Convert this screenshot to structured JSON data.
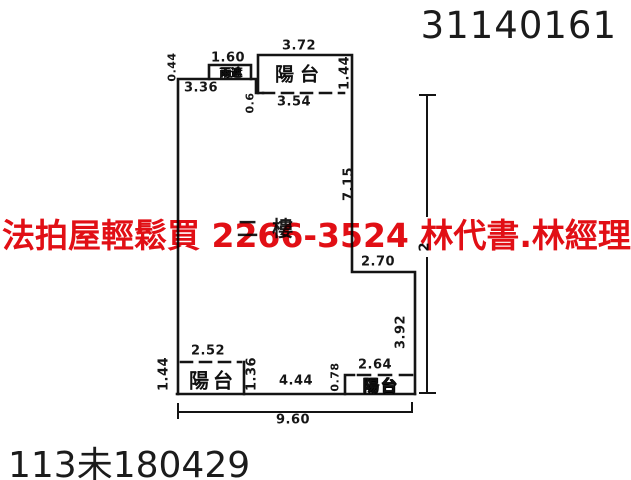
{
  "header": {
    "ref_number": "31140161"
  },
  "footer": {
    "case_number": "113未180429"
  },
  "watermark": {
    "text": "法拍屋輕鬆買  2266-3524  林代書.林經理",
    "color": "#e10f15"
  },
  "floorplan": {
    "floor_label": "二樓",
    "rooms": {
      "rain_cover_label": "雨遮",
      "balcony_top_label": "陽台",
      "balcony_bottom_left_label": "陽台",
      "balcony_bottom_right_label": "陽台"
    },
    "dimensions": {
      "rain_cover_height": "0.44",
      "rain_cover_width": "1.60",
      "top_wall": "3.36",
      "top_step": "0.6",
      "balcony_top_width": "3.72",
      "balcony_top_depth": "1.44",
      "balcony_top_opening": "3.54",
      "right_wall_upper": "7.15",
      "notch_width": "2.70",
      "right_wall_lower": "3.92",
      "balcony_left_width": "2.52",
      "balcony_left_depth_outer": "1.44",
      "balcony_left_depth_inner": "1.36",
      "bottom_middle_wall": "4.44",
      "balcony_right_step": "0.78",
      "balcony_right_width": "2.64",
      "total_width": "9.60",
      "right_total_fragment": "2"
    }
  }
}
